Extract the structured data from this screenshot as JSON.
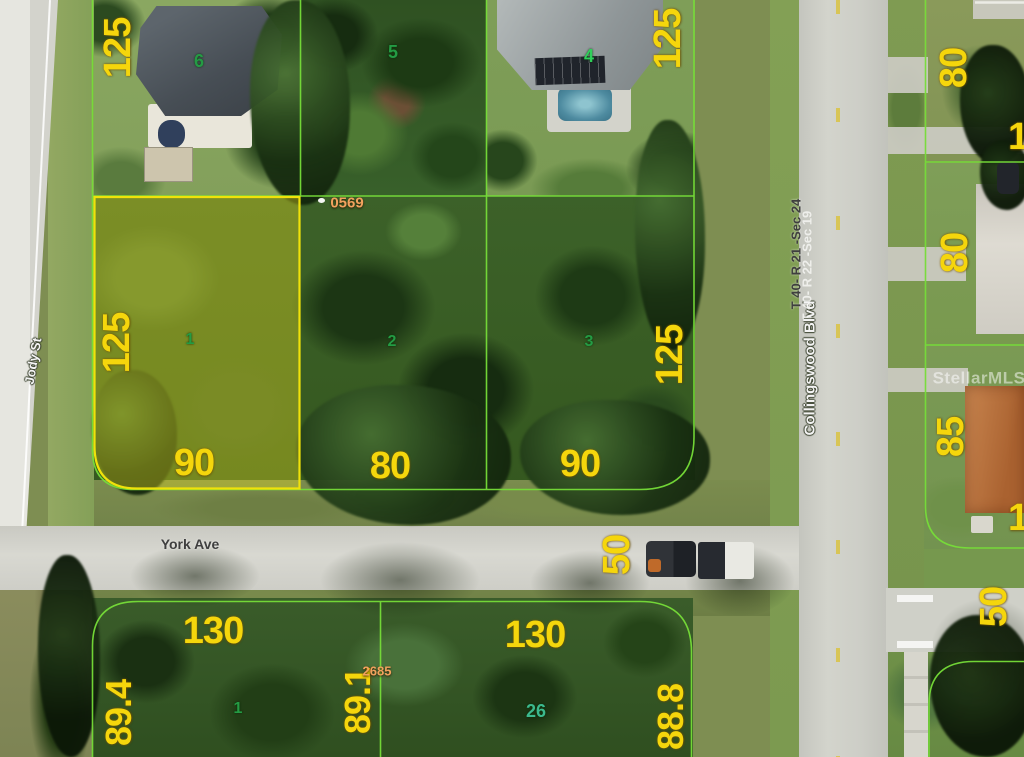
{
  "watermark": "StellarMLS",
  "streets": {
    "jody": "Jody St",
    "york": "York Ave",
    "collingswood": "Collingswood Blvd"
  },
  "sections": {
    "primary": "T 40- R 21 -Sec 24",
    "secondary": "T 40- R 22 -Sec 19"
  },
  "refs": {
    "top": "0569",
    "bottom": "2685"
  },
  "lot_numbers": {
    "lot1": "1",
    "lot2": "2",
    "lot3": "3",
    "lot4": "4",
    "lot5": "5",
    "lot6": "6",
    "south1": "1",
    "south26": "26"
  },
  "dimensions": {
    "lot6_west": "125",
    "lot4_east": "125",
    "lot1_west": "125",
    "lot1_front": "90",
    "lot2_front": "80",
    "lot3_front": "90",
    "lot3_east": "125",
    "york_half": "50",
    "south_left_front": "130",
    "south_right_front": "130",
    "south_west": "89.4",
    "south_mid": "89.1",
    "south_east": "88.8",
    "right_top_a": "80",
    "right_top_b": "80",
    "right_85": "85",
    "right_50": "50",
    "right_edge_partial_a": "1",
    "right_edge_partial_b": "1"
  },
  "colors": {
    "dimension_text": "#f5d60c",
    "lot_number_text": "#249b44",
    "parcel_line": "#76dd38",
    "highlight_border": "#f0e20a",
    "highlight_fill": "rgba(225,215,35,0.38)",
    "ref_text": "#f2a25e"
  }
}
